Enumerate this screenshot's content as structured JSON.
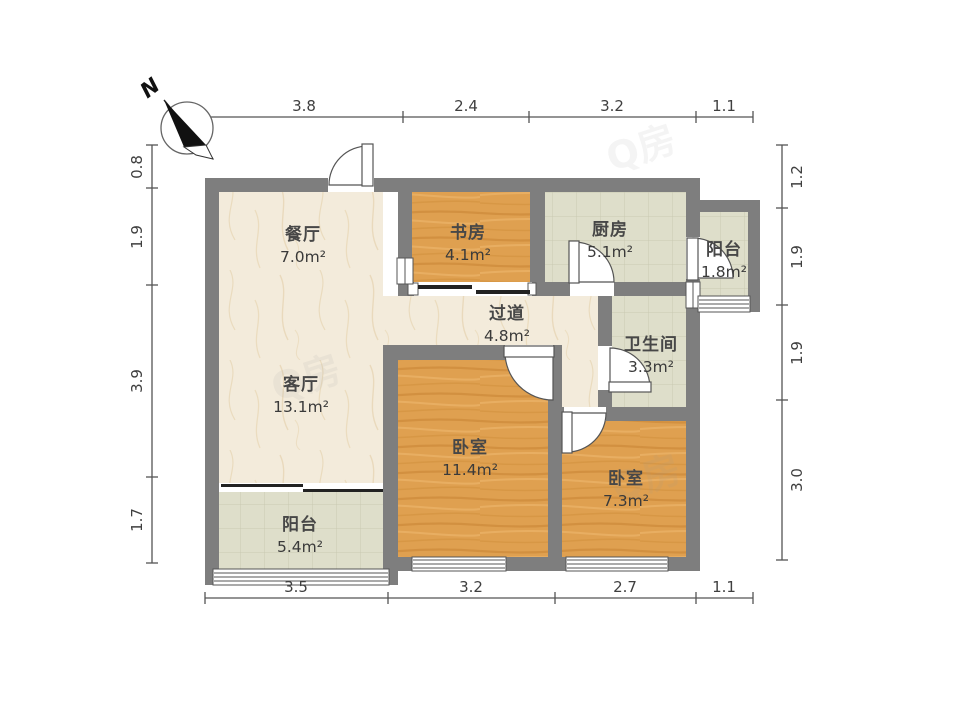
{
  "compass": {
    "label": "N"
  },
  "watermark": "Q房",
  "rooms": [
    {
      "id": "dining",
      "name": "餐厅",
      "area": "7.0m²"
    },
    {
      "id": "study",
      "name": "书房",
      "area": "4.1m²"
    },
    {
      "id": "kitchen",
      "name": "厨房",
      "area": "5.1m²"
    },
    {
      "id": "balcony-top",
      "name": "阳台",
      "area": "1.8m²"
    },
    {
      "id": "hallway",
      "name": "过道",
      "area": "4.8m²"
    },
    {
      "id": "bathroom",
      "name": "卫生间",
      "area": "3.3m²"
    },
    {
      "id": "living",
      "name": "客厅",
      "area": "13.1m²"
    },
    {
      "id": "bedroom-main",
      "name": "卧室",
      "area": "11.4m²"
    },
    {
      "id": "bedroom-second",
      "name": "卧室",
      "area": "7.3m²"
    },
    {
      "id": "balcony-bottom",
      "name": "阳台",
      "area": "5.4m²"
    }
  ],
  "dimensions": {
    "top": [
      "3.8",
      "2.4",
      "3.2",
      "1.1"
    ],
    "bottom": [
      "3.5",
      "3.2",
      "2.7",
      "1.1"
    ],
    "left": [
      "0.8",
      "1.9",
      "3.9",
      "1.7"
    ],
    "right": [
      "1.2",
      "1.9",
      "1.9",
      "3.0"
    ]
  },
  "colors": {
    "wall": "#7e7e7e",
    "marble_floor": "#f3ebdb",
    "wood_floor": "#dfa050",
    "tile_floor": "#dedeca",
    "dimension_line": "#555555"
  }
}
